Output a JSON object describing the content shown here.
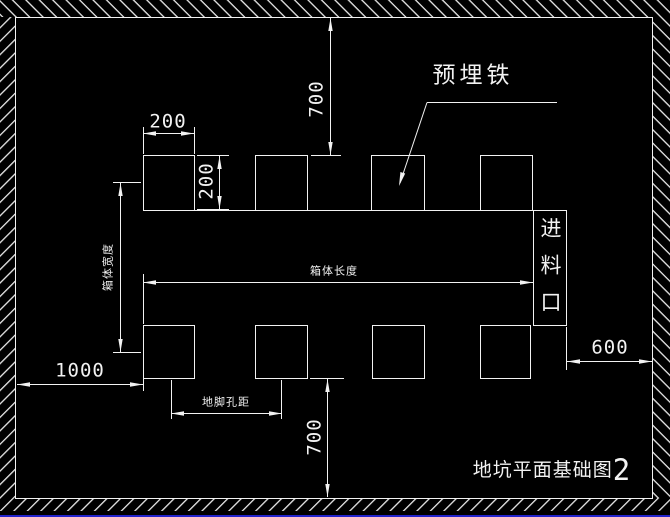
{
  "drawing": {
    "type": "cad-foundation-plan",
    "full_title": "地坑平面基础图2",
    "title_text": "地坑平面基础图",
    "figure_number": "2",
    "callouts": {
      "embedded_iron": "预埋铁",
      "feed_inlet": "进料口"
    },
    "dimension_labels": {
      "box_length": "箱体长度",
      "box_width": "箱体宽度",
      "anchor_hole_spacing": "地脚孔距"
    },
    "dimension_values": {
      "top_clearance": "700",
      "plate_width": "200",
      "plate_height": "200",
      "left_clearance": "1000",
      "bottom_clearance": "700",
      "right_clearance": "600"
    },
    "colors": {
      "background": "#000000",
      "linework": "#f2f2f2",
      "bottom_screen_edge": "#2323cc"
    }
  }
}
